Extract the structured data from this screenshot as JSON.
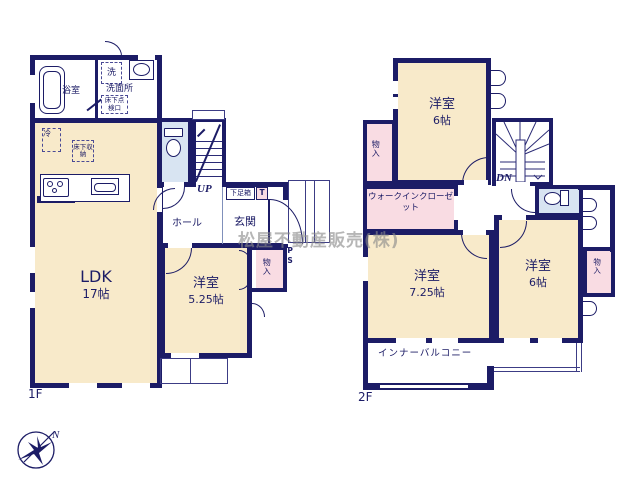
{
  "watermark": "松屋不動産販売(株)",
  "compass": {
    "north_label": "N"
  },
  "palette": {
    "wall_color": "#1c1c66",
    "room_fill": "#f8eaca",
    "closet_fill": "#f9dce3",
    "sanitary_fill": "#d8e4f2"
  },
  "floor1": {
    "label": "1F",
    "ldk": {
      "name": "LDK",
      "size": "17帖"
    },
    "bedroom": {
      "name": "洋室",
      "size": "5.25帖"
    },
    "bathroom": "浴室",
    "washroom": "洗面所",
    "laundry": "洗",
    "fridge": "冷",
    "underfloor_storage": "床下収納",
    "underfloor_hatch": "床下点検口",
    "hall": "ホール",
    "entrance": "玄関",
    "shoe_box": "下足箱",
    "toilet_mark": "T",
    "closet": "物入",
    "stairs_up": "UP",
    "pipe_space": "PS"
  },
  "floor2": {
    "label": "2F",
    "bedroom_north": {
      "name": "洋室",
      "size": "6帖"
    },
    "bedroom_south": {
      "name": "洋室",
      "size": "7.25帖"
    },
    "bedroom_east": {
      "name": "洋室",
      "size": "6帖"
    },
    "walk_in_closet": "ウォークインクローゼット",
    "closet_west": "物入",
    "closet_east": "物入",
    "inner_balcony": "インナーバルコニー",
    "stairs_down": "DN"
  }
}
